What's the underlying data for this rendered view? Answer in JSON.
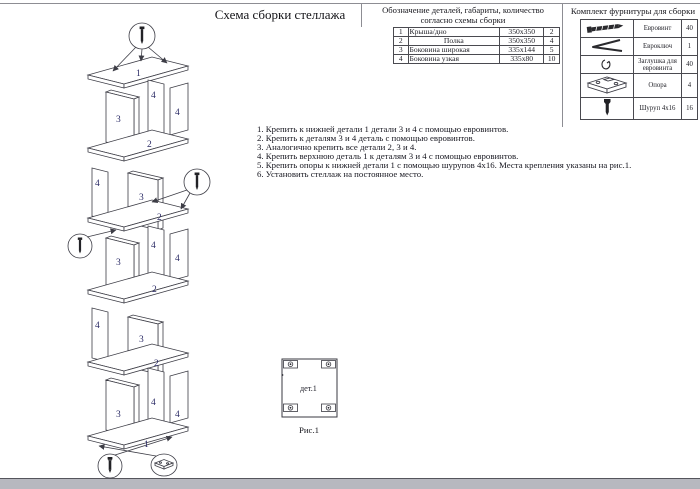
{
  "page": {
    "title": "Схема сборки стеллажа"
  },
  "parts_table": {
    "title_line1": "Обозначение деталей, габариты, количество",
    "title_line2": "согласно схемы сборки",
    "rows": [
      {
        "num": "1",
        "name": "Крыша/дно",
        "name_centered": false,
        "size": "350х350",
        "qty": "2"
      },
      {
        "num": "2",
        "name": "Полка",
        "name_centered": true,
        "size": "350х350",
        "qty": "4"
      },
      {
        "num": "3",
        "name": "Боковина широкая",
        "name_centered": false,
        "size": "335х144",
        "qty": "5"
      },
      {
        "num": "4",
        "name": "Боковина узкая",
        "name_centered": false,
        "size": "335х80",
        "qty": "10"
      }
    ]
  },
  "hardware_table": {
    "title": "Комплект фурнитуры для сборки",
    "rows": [
      {
        "icon": "euro-screw-icon",
        "name": "Евровинт",
        "qty": "40"
      },
      {
        "icon": "hex-key-icon",
        "name": "Евроключ",
        "qty": "1"
      },
      {
        "icon": "cap-icon",
        "name": "Заглушка для евровинта",
        "qty": "40"
      },
      {
        "icon": "support-icon",
        "name": "Опора",
        "qty": "4"
      },
      {
        "icon": "screw-icon",
        "name": "Шуруп 4х16",
        "qty": "16"
      }
    ]
  },
  "instructions": {
    "items": [
      "1. Крепить к нижней детали 1 детали 3 и 4 с помощью евровинтов.",
      "2. Крепить к деталям 3 и 4 деталь с помощью евровинтов.",
      "3. Аналогично крепить все детали 2, 3 и 4.",
      "4. Крепить верхнюю деталь 1 к деталям 3 и 4 с помощью евровинтов.",
      "5. Крепить опоры к нижней детали 1 с помощью шурупов 4х16. Места крепления указаны на рис.1.",
      "6. Установить стеллаж на постоянное место."
    ]
  },
  "diagram": {
    "labels": [
      "1",
      "3",
      "4",
      "4",
      "2",
      "4",
      "3",
      "2",
      "4",
      "3",
      "4",
      "2",
      "4",
      "3",
      "2",
      "3",
      "4",
      "4",
      "1"
    ],
    "callouts": [
      "euro-screw",
      "euro-screw",
      "euro-screw",
      "wood-screw",
      "support-foot"
    ]
  },
  "figure": {
    "label": "дет.1",
    "caption": "Рис.1"
  },
  "colors": {
    "line": "#3d3d46",
    "text": "#1b1b22",
    "diagram_label": "#2b2b66",
    "page_edge_strip": "#b7b8bf"
  }
}
